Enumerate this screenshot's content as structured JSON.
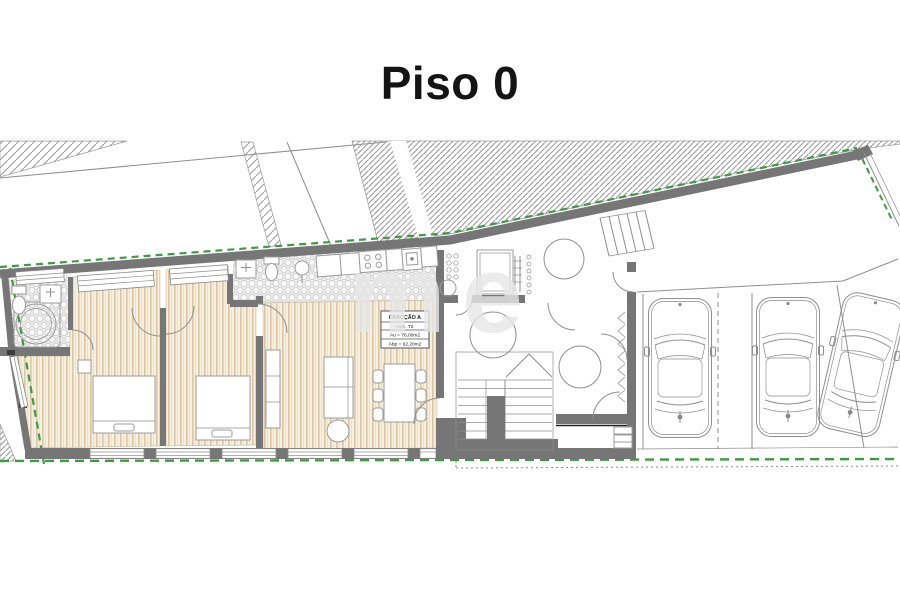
{
  "title": "Piso 0",
  "unit_label": {
    "name": "FRACÇÃO A",
    "type": "Hab. T2",
    "area_util": "Au = 76,00m2",
    "area_gross": "Abp = 92,20m2"
  },
  "watermark_text": "me",
  "parking": {
    "car_count": 3
  },
  "colors": {
    "wall": "#767676",
    "line": "#8f8f8f",
    "green": "#3f9a44",
    "wood": "#f7f0e1",
    "wood_stripe": "#dbc7a3",
    "title_color": "#141414",
    "watermark": "#e7e7e7"
  }
}
